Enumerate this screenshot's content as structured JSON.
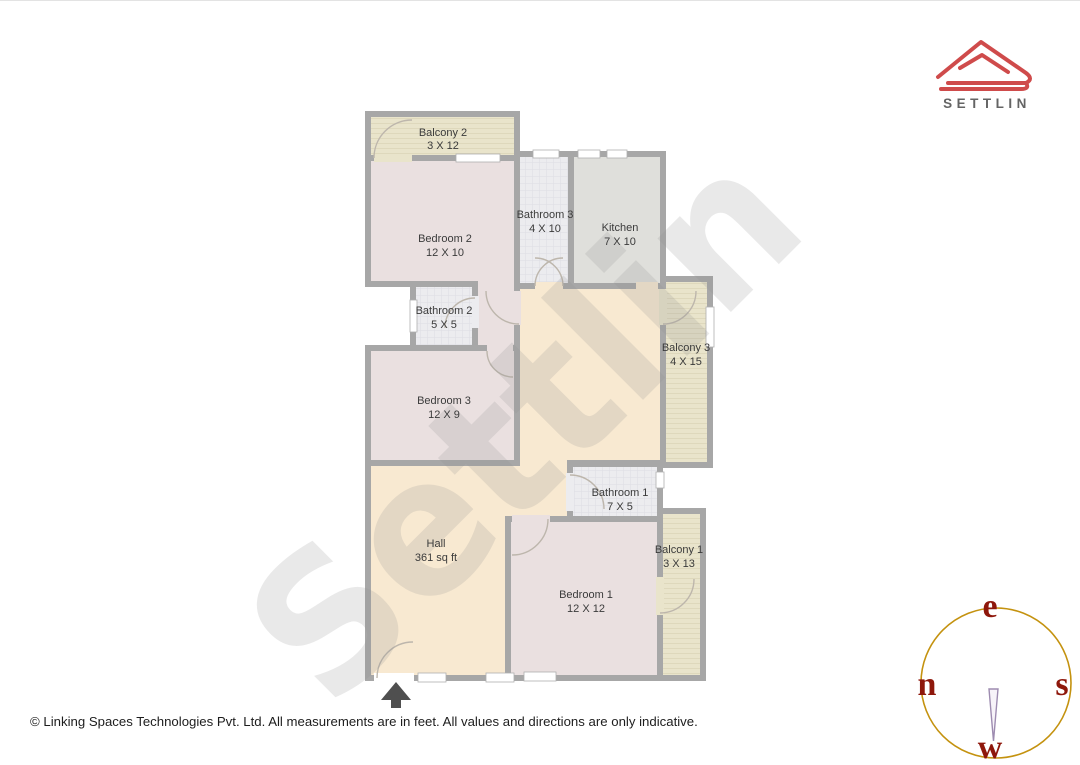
{
  "watermark": {
    "text": "Settlin"
  },
  "logo": {
    "brand": "SETTLIN",
    "accent_color": "#cf4b4b",
    "text_color": "#646464"
  },
  "rooms": {
    "balcony2": {
      "name": "Balcony 2",
      "dims": "3 X 12"
    },
    "bedroom2": {
      "name": "Bedroom 2",
      "dims": "12 X 10"
    },
    "bathroom3": {
      "name": "Bathroom 3",
      "dims": "4 X 10"
    },
    "kitchen": {
      "name": "Kitchen",
      "dims": "7 X 10"
    },
    "bathroom2": {
      "name": "Bathroom 2",
      "dims": "5 X 5"
    },
    "bedroom3": {
      "name": "Bedroom 3",
      "dims": "12 X 9"
    },
    "balcony3": {
      "name": "Balcony 3",
      "dims": "4 X 15"
    },
    "hall": {
      "name": "Hall",
      "dims": "361 sq ft"
    },
    "bathroom1": {
      "name": "Bathroom 1",
      "dims": "7 X 5"
    },
    "bedroom1": {
      "name": "Bedroom 1",
      "dims": "12 X 12"
    },
    "balcony1": {
      "name": "Balcony 1",
      "dims": "3 X 13"
    }
  },
  "compass": {
    "top": "e",
    "left": "n",
    "right": "s",
    "bottom": "w",
    "ring_color": "#c4920f",
    "letter_color": "#8e170b"
  },
  "footer": {
    "copyright": "© Linking Spaces Technologies Pvt. Ltd. All measurements are in feet. All values and directions are only indicative."
  },
  "palette": {
    "wall": "#a7a7a7",
    "hall": "#f8e9d1",
    "bedroom": "#eae0e0",
    "bathroom": "#ececef",
    "kitchen": "#dfdfdb",
    "balcony": "#e9e4cb"
  }
}
